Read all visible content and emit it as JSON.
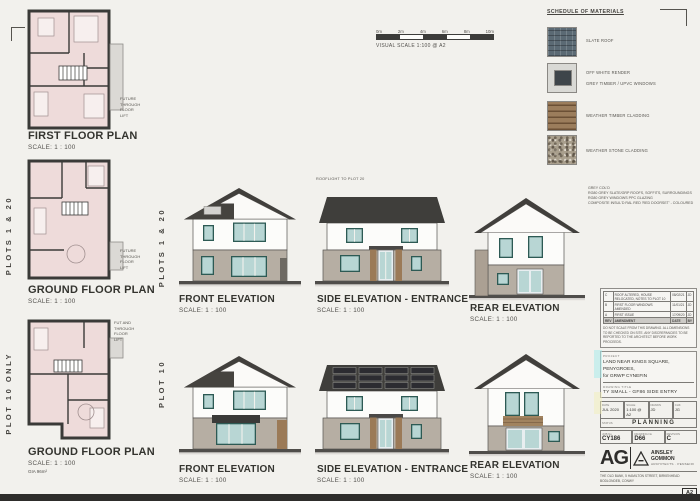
{
  "sheet": {
    "paper_color": "#f2f1ed",
    "ink_color": "#3c3c3a",
    "window_accent": "#2d5a54",
    "roof_color": "#413f3c",
    "stone_color": "#b6aea3",
    "plan_fill": "#eedbda",
    "scale_bar": {
      "ticks": [
        "0m",
        "2m",
        "4m",
        "6m",
        "8m",
        "10m"
      ],
      "caption": "VISUAL SCALE 1:100 @ A2"
    }
  },
  "plans": [
    {
      "title": "FIRST FLOOR PLAN",
      "scale": "SCALE:  1 : 100",
      "note": "FUTURE\nTHROUGH\nFLOOR\nLIFT"
    },
    {
      "title": "GROUND FLOOR PLAN",
      "scale": "SCALE:  1 : 100",
      "note": "FUTURE\nTHROUGH\nFLOOR\nLIFT",
      "side_label": "PLOTS 1 & 20"
    },
    {
      "title": "GROUND FLOOR PLAN",
      "scale": "SCALE:  1 : 100",
      "note": "FUT AND\nTHROUGH\nFLOOR\nLIFT",
      "side_label": "PLOT 10 ONLY",
      "area_note": "GIA 96m²"
    }
  ],
  "elevations": {
    "row1": {
      "side_label": "PLOTS 1 & 20",
      "front": {
        "title": "FRONT ELEVATION",
        "scale": "SCALE:  1 : 100"
      },
      "side": {
        "title": "SIDE ELEVATION - ENTRANCE",
        "scale": "SCALE:  1 : 100",
        "annotation": "ROOFLIGHT TO PLOT 20"
      },
      "rear": {
        "title": "REAR ELEVATION",
        "scale": "SCALE:  1 : 100"
      }
    },
    "row2": {
      "side_label": "PLOT 10",
      "front": {
        "title": "FRONT ELEVATION",
        "scale": "SCALE:  1 : 100"
      },
      "side": {
        "title": "SIDE ELEVATION - ENTRANCE",
        "scale": "SCALE:  1 : 100"
      },
      "rear": {
        "title": "REAR ELEVATION",
        "scale": "SCALE:  1 : 100"
      }
    }
  },
  "materials": {
    "title": "SCHEDULE OF MATERIALS",
    "items": [
      {
        "label": "SLATE ROOF"
      },
      {
        "label": "OFF WHITE RENDER",
        "label2": "GREY TIMBER / UPVC WINDOWS"
      },
      {
        "label": "WEATHER TIMBER CLADDING"
      },
      {
        "label": "WEATHER STONE CLADDING"
      }
    ]
  },
  "notes": {
    "lines": "GREY COL'D\nRG80 GREY SLATE/GRP ROOFS, SOFFITS, SURROUNDINGS\nRG80 GREY WINDOWS PPC GLAZING\nCOMPOSITE INSUL'D RAL RED 'RED DOORSET' - COLOURED"
  },
  "title_block": {
    "revisions_header": {
      "rev": "REV",
      "desc": "AMENDMENT",
      "date": "DATE",
      "by": "BY"
    },
    "revisions": [
      {
        "rev": "C",
        "desc": "ROOF ALTERED, HOUSE RELOCATED, NOTES TO PLOT 10",
        "date": "08/02/21",
        "by": "JD"
      },
      {
        "rev": "B",
        "desc": "FIRST FLOOR WINDOWS AMENDED",
        "date": "11/01/21",
        "by": "JD"
      },
      {
        "rev": "A",
        "desc": "FIRST ISSUE",
        "date": "17/09/20",
        "by": "JD"
      }
    ],
    "disclaimer": "DO NOT SCALE FROM THIS DRAWING. ALL DIMENSIONS TO BE CHECKED ON SITE. ANY DISCREPANCIES TO BE REPORTED TO THE ARCHITECT BEFORE WORK PROCEEDS.",
    "project_label": "PROJECT",
    "project": "LAND NEAR KINGS SQUARE,\nPENYGROES,\nfor GRWP CYNEFIN",
    "drawing_title_label": "DRAWING TITLE",
    "drawing_title": "TY SMALL - GF86 SIDE ENTRY",
    "meta": {
      "date_label": "DATE",
      "date": "JUL 2020",
      "scale_label": "SCALE",
      "scale": "1:100 @ A2",
      "drawn_label": "DRAWN",
      "drawn": "JD",
      "check_label": "CHK",
      "check": "JG"
    },
    "status_label": "STATUS",
    "status": "PLANNING",
    "job_label": "JOB No",
    "job": "CY186",
    "dwg_label": "DRAWING No",
    "dwg": "D66",
    "rev_label": "REVISION",
    "rev": "C",
    "logo": {
      "ag": "AG",
      "name": "AINSLEY\nGOMMON",
      "subtitle": "ARCHITECTS · PENSEIRI"
    },
    "address": "THE OLD BANK, 5 HAMILTON STREET, BIRKENHEAD\nBODLONDEB, CONWY",
    "sheet_size": "A2"
  }
}
